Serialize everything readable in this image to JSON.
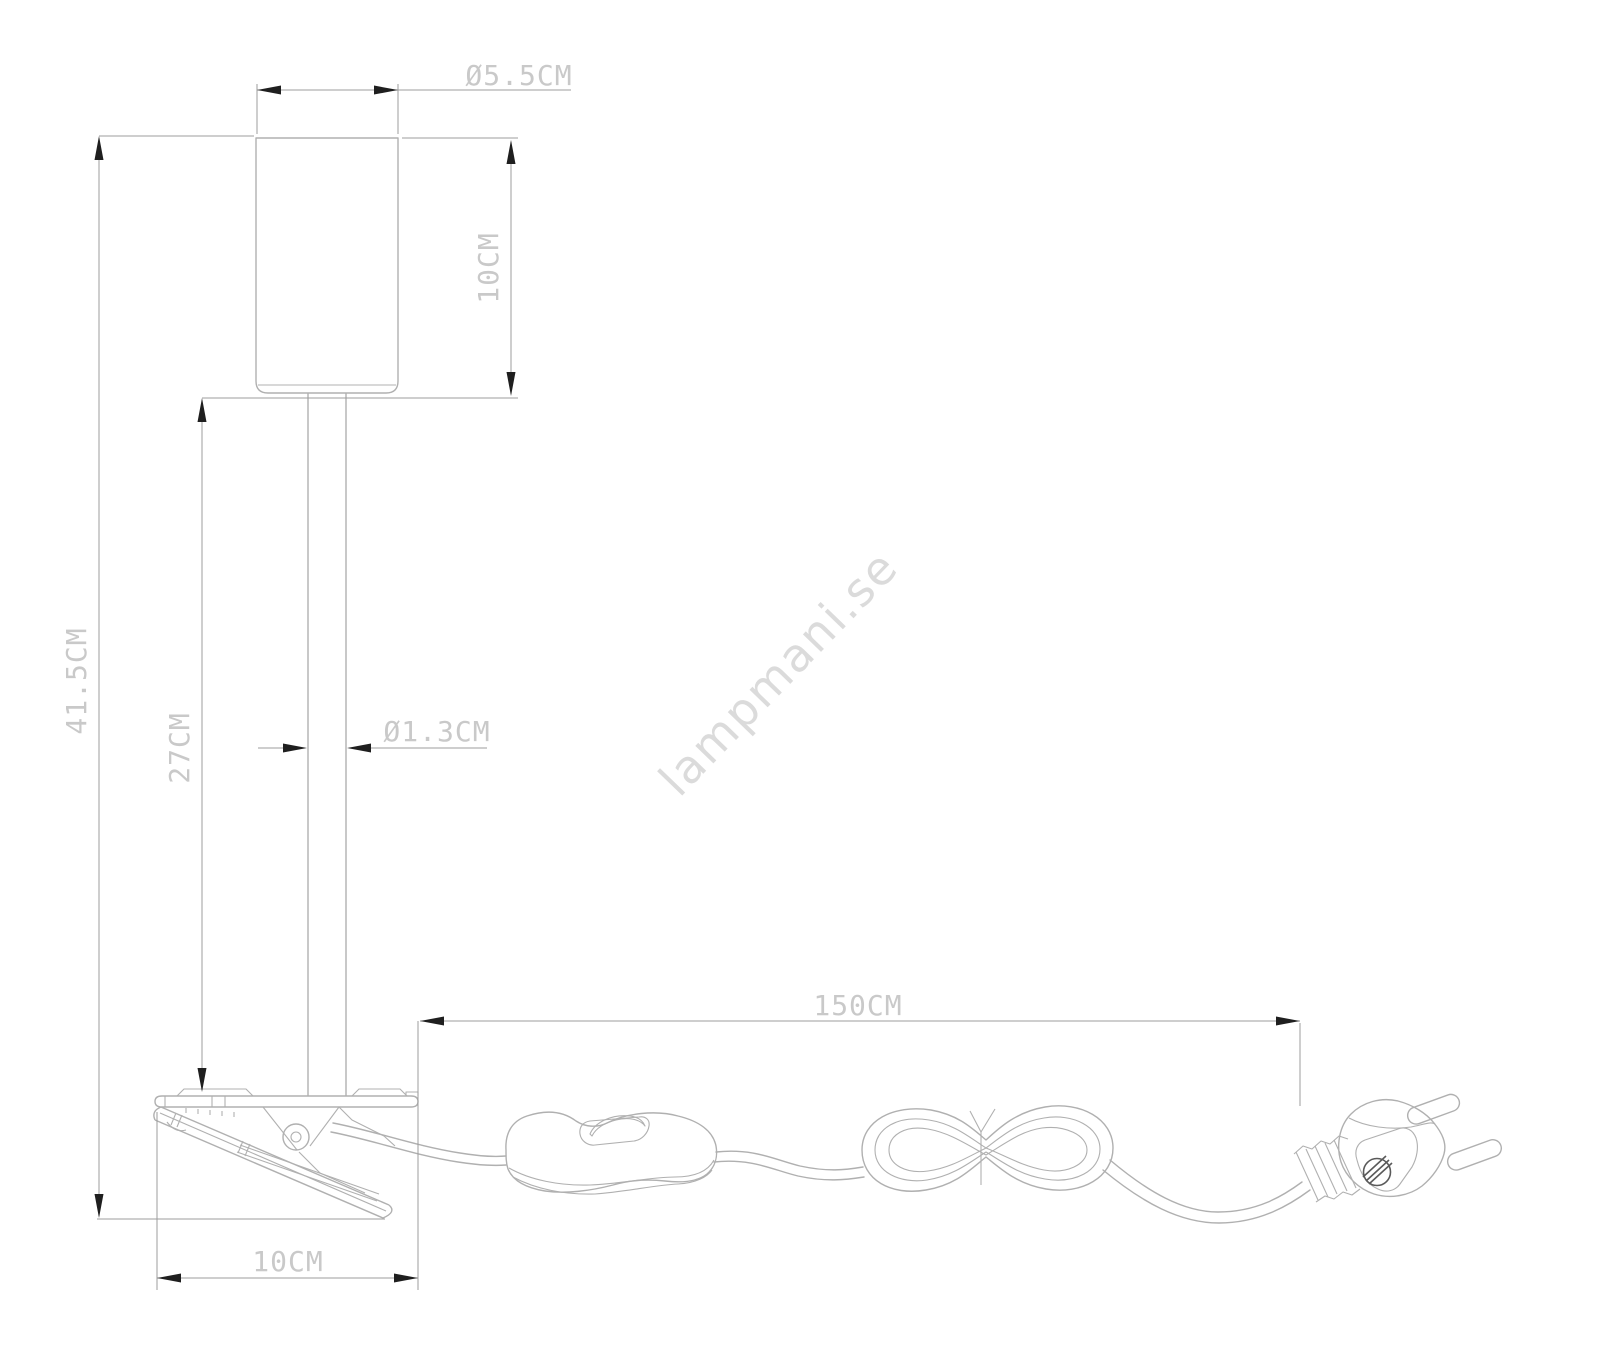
{
  "labels": {
    "shade_diameter": "Ø5.5CM",
    "shade_height": "10CM",
    "overall_height": "41.5CM",
    "stem_height": "27CM",
    "stem_diameter": "Ø1.3CM",
    "cable_length": "150CM",
    "clamp_width": "10CM"
  },
  "watermark": "lampmani.se",
  "colors": {
    "background": "#ffffff",
    "object_line": "#b0b0b0",
    "dimension_line": "#9c9c9c",
    "arrow": "#1f1f1f",
    "label_text": "#c9c9c9",
    "watermark_text": "#dbdbdb"
  }
}
